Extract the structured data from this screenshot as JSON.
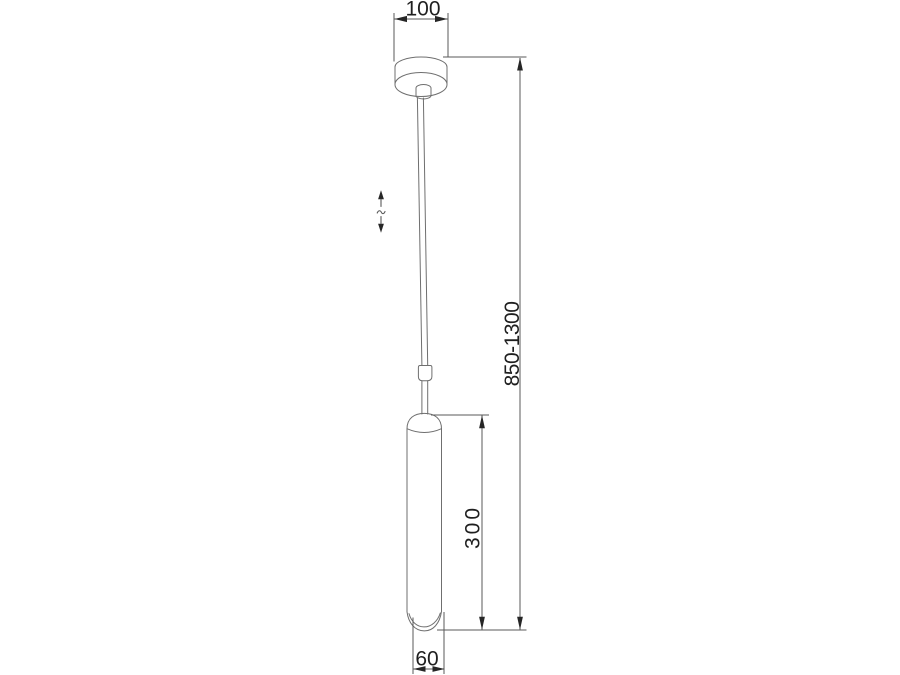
{
  "meta": {
    "title": "Pendant luminaire dimensional drawing"
  },
  "dimensions": {
    "canopy_width_mm": "100",
    "suspension_height_mm": "850-1300",
    "body_height_mm": "300",
    "body_diameter_mm": "60"
  },
  "icons": {
    "height_adjustable": "vertical-double-arrow-icon"
  },
  "colors": {
    "background": "#ffffff",
    "object_line": "#6f6f6f",
    "dimension_line": "#5a5a5a",
    "arrow": "#262626",
    "text": "#1f1f1f"
  }
}
